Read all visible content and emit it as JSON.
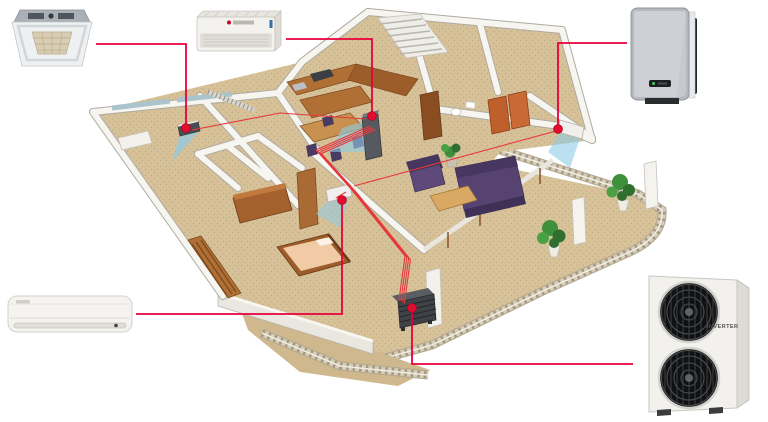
{
  "diagram": {
    "type": "illustration",
    "subject": "Multi-split air conditioning system in an apartment - isometric cutaway floor plan with product callouts",
    "accent_color": "#e8003d",
    "pipe_color": "#e5393c",
    "airflow_color": "#8ecbe4",
    "floor_color": "#d7c198",
    "wall_color": "#f6f5f0",
    "outdoor_unit": {
      "brand_label": "INVERTER"
    },
    "units": [
      {
        "id": "ceiling-cassette",
        "name": "Ceiling cassette indoor unit",
        "position": "top-left photo"
      },
      {
        "id": "floor-ceiling-console",
        "name": "Floor/ceiling console indoor unit",
        "position": "top-center photo"
      },
      {
        "id": "air-purifier",
        "name": "Wall-mounted air purifier unit",
        "position": "top-right photo"
      },
      {
        "id": "wall-split",
        "name": "Wall-mounted split indoor unit",
        "position": "bottom-left photo"
      },
      {
        "id": "outdoor-inverter",
        "name": "Outdoor inverter compressor unit with two fans",
        "position": "bottom-right photo",
        "label": "INVERTER"
      },
      {
        "id": "balcony-condenser",
        "name": "Compact condenser unit on balcony",
        "position": "center-bottom of floor plan"
      }
    ]
  }
}
